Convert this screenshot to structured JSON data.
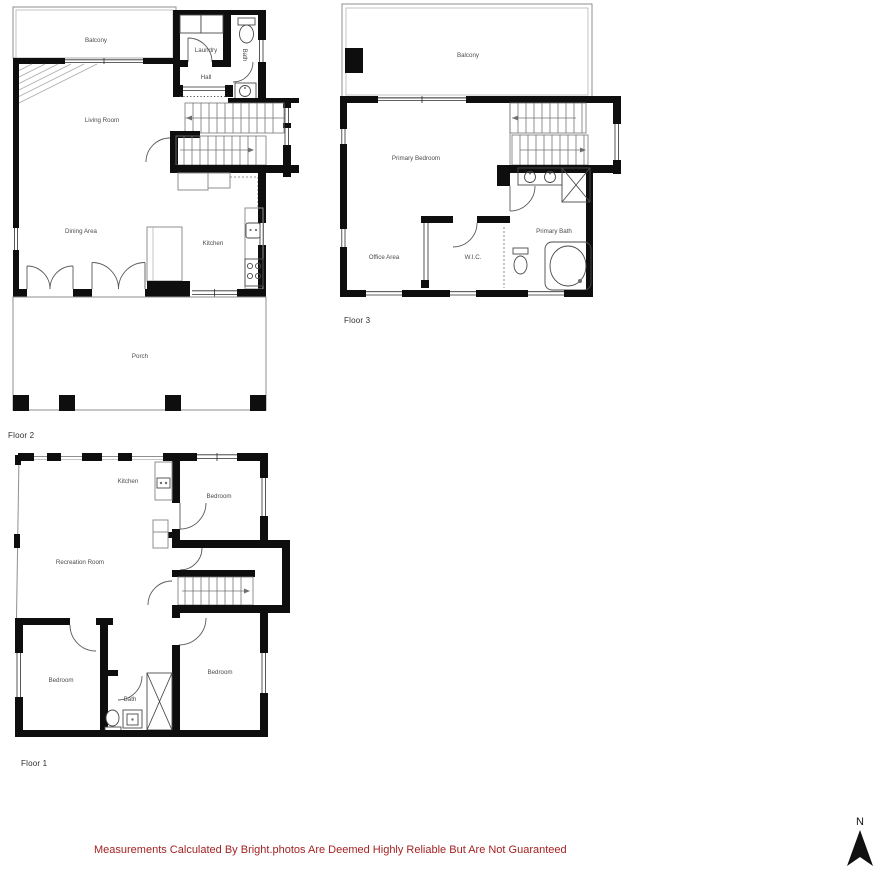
{
  "colors": {
    "wall": "#0e0e0e",
    "disclaimer_text": "#a42222"
  },
  "floor2": {
    "label": "Floor 2",
    "rooms": {
      "balcony": "Balcony",
      "laundry": "Laundry",
      "hall": "Hall",
      "bath": "Bath",
      "living_room": "Living Room",
      "dining_area": "Dining Area",
      "kitchen": "Kitchen",
      "porch": "Porch"
    }
  },
  "floor3": {
    "label": "Floor 3",
    "rooms": {
      "balcony": "Balcony",
      "primary_bedroom": "Primary Bedroom",
      "office_area": "Office Area",
      "wic": "W.I.C.",
      "primary_bath": "Primary Bath"
    }
  },
  "floor1": {
    "label": "Floor 1",
    "rooms": {
      "kitchen": "Kitchen",
      "bedroom_top": "Bedroom",
      "recreation_room": "Recreation Room",
      "bedroom_right": "Bedroom",
      "bath": "Bath",
      "bedroom_left": "Bedroom"
    }
  },
  "footer": {
    "disclaimer": "Measurements Calculated By Bright.photos Are Deemed Highly Reliable But Are Not Guaranteed"
  },
  "compass": {
    "label": "N"
  }
}
